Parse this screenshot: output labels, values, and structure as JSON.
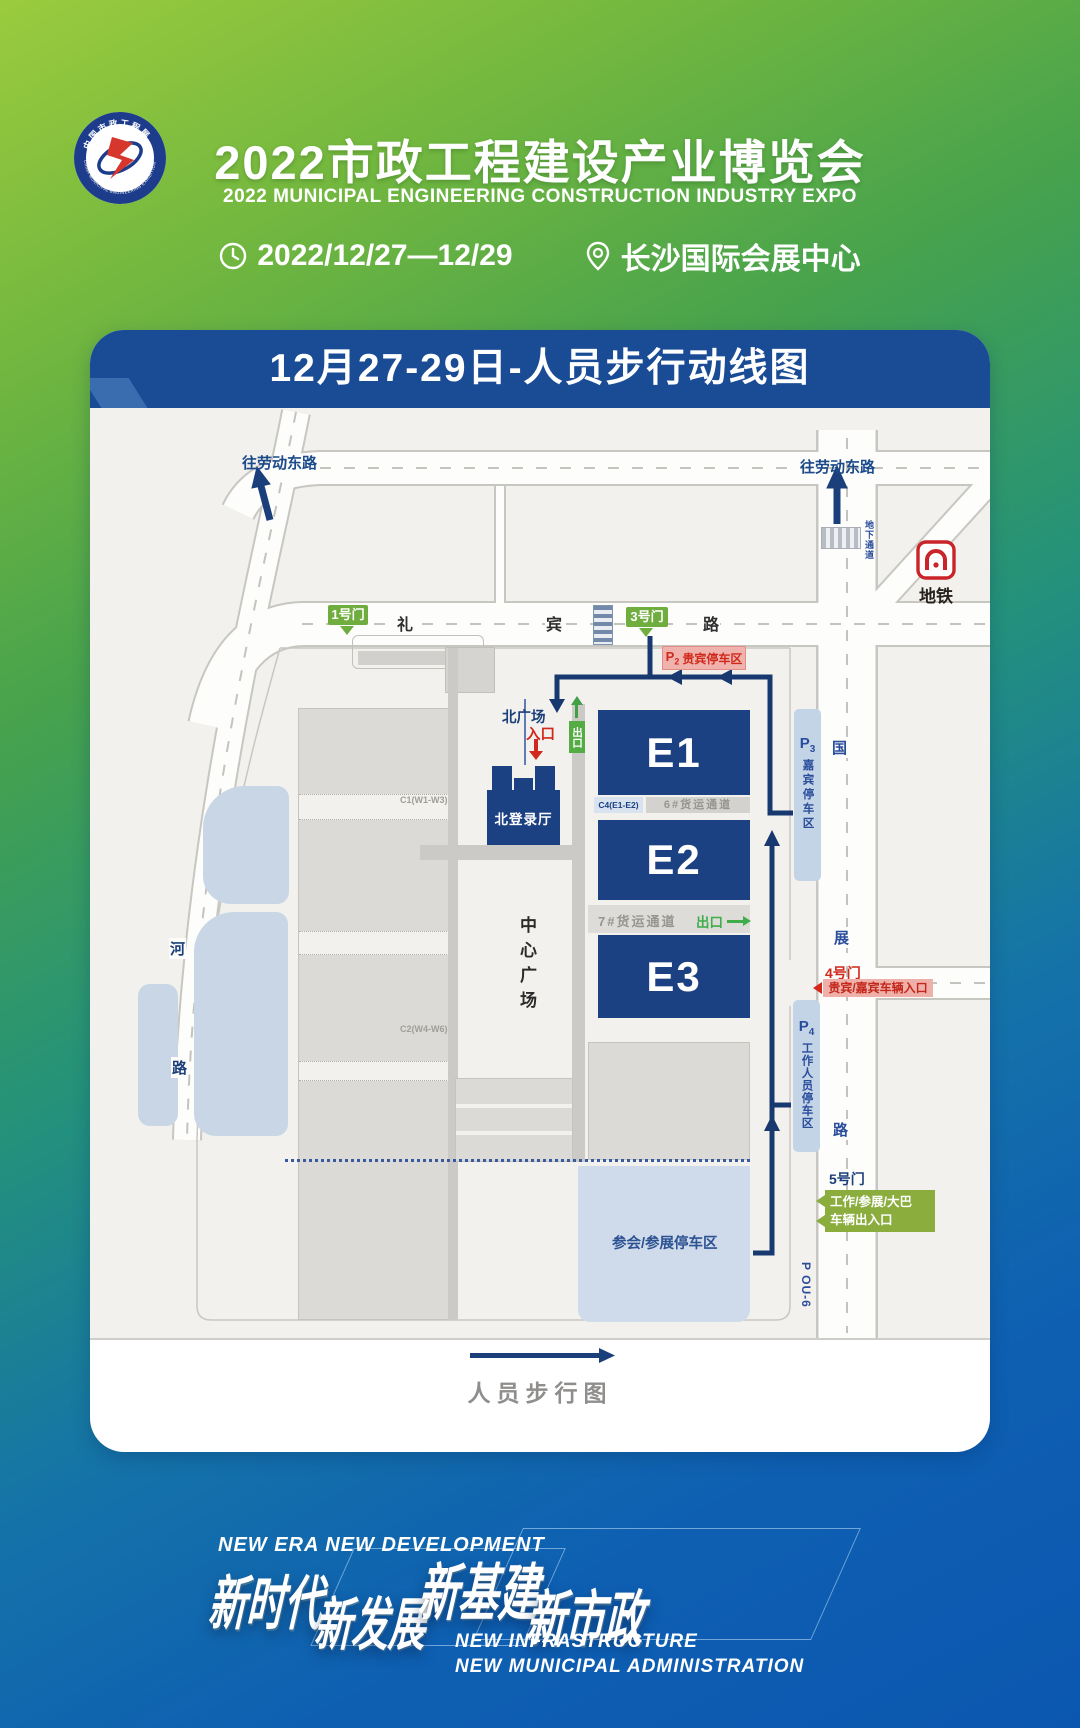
{
  "theme": {
    "green": "#8dc63f",
    "blue": "#0d5ab3",
    "banner_blue": "#1a4c96",
    "hall_blue": "#1c4182",
    "route_navy": "#18396f",
    "gate_green": "#6fae3e",
    "exit_green": "#43a047",
    "alert_red": "#d0291c",
    "pink": "#efb0aa",
    "parking_blue": "#cfdbea"
  },
  "header": {
    "logo": {
      "ring_top": "中国市政工程展",
      "ring_bottom": "CHINA MUNICIPAL ENGINEERING EXHIBITION"
    },
    "title": "2022市政工程建设产业博览会",
    "subtitle": "2022 MUNICIPAL ENGINEERING CONSTRUCTION INDUSTRY EXPO",
    "date": "2022/12/27—12/29",
    "venue": "长沙国际会展中心"
  },
  "card": {
    "banner_title": "12月27-29日-人员步行动线图",
    "legend": "人员步行图"
  },
  "map": {
    "roads": {
      "libin": [
        "礼",
        "宾",
        "路"
      ],
      "guozhan": [
        "国",
        "展",
        "路"
      ],
      "riverside": [
        "河",
        "路"
      ],
      "to_laodong_left": "往劳动东路",
      "to_laodong_right": "往劳动东路",
      "underpass": "地下通道"
    },
    "metro": "地铁",
    "gates": {
      "g1": "1号门",
      "g3": "3号门",
      "g4": {
        "name": "4号门",
        "desc": "贵宾/嘉宾车辆入口"
      },
      "g5": {
        "name": "5号门",
        "desc_line1": "工作/参展/大巴",
        "desc_line2": "车辆出入口"
      }
    },
    "halls": {
      "e1": "E1",
      "e2": "E2",
      "e3": "E3",
      "north_login": "北登录厅",
      "c1": "C1(W1-W3)",
      "c2": "C2(W4-W6)"
    },
    "corridors": {
      "c4": "C4(E1-E2)",
      "f6": "6#货运通道",
      "f7": "7#货运通道"
    },
    "plaza": "中心广场",
    "north_plaza": {
      "name": "北广场",
      "entry": "入口"
    },
    "exit_north": "出口",
    "exit_east": "出口",
    "parking": {
      "p2": {
        "letter": "P",
        "digit": "2",
        "name": "贵宾停车区"
      },
      "p3": {
        "letter": "P",
        "digit": "3",
        "name": "嘉宾停车区"
      },
      "p4": {
        "letter": "P",
        "digit": "4",
        "name": "工作人员停车区"
      },
      "south": "参会/参展停车区",
      "pou6": "P OU-6"
    }
  },
  "footer": {
    "en_top": "NEW ERA  NEW DEVELOPMENT",
    "slogan1": "新时代",
    "slogan2": "新发展",
    "slogan3": "新基建",
    "slogan4": "新市政",
    "en_b1": "NEW INFRASTRUCTURE",
    "en_b2": "NEW MUNICIPAL ADMINISTRATION"
  }
}
